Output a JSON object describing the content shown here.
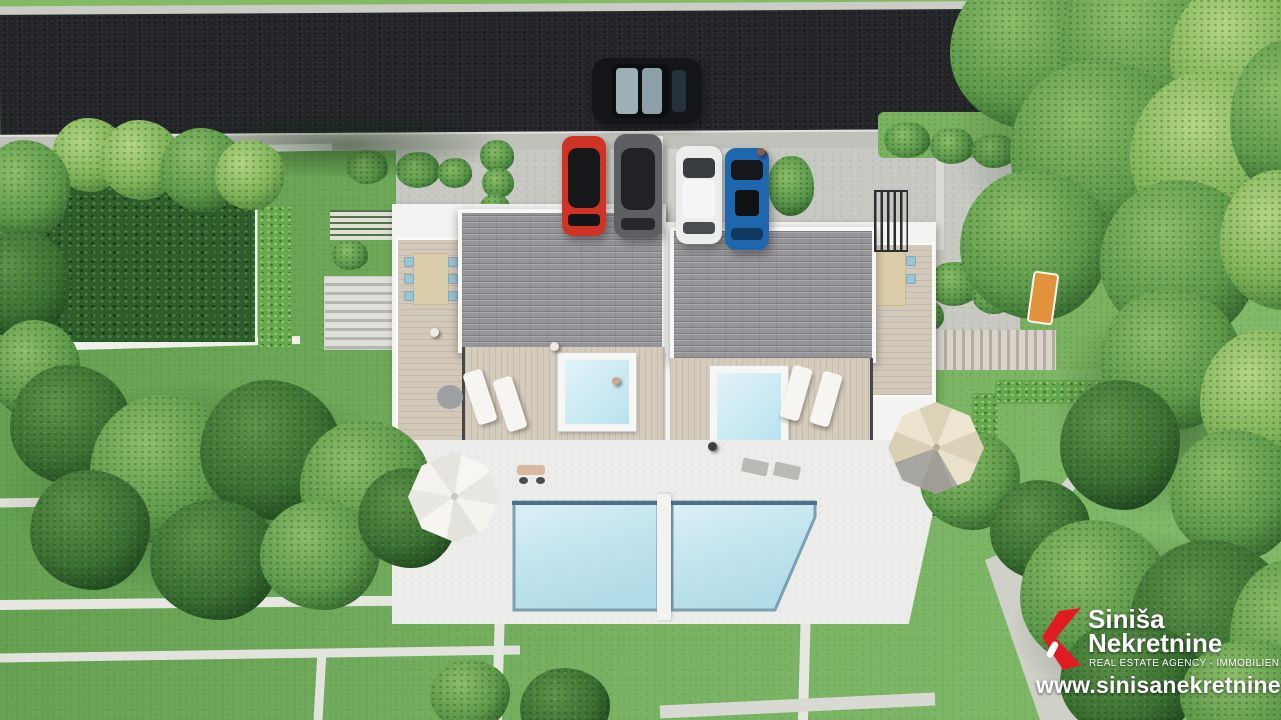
{
  "watermark": {
    "brand_line1": "Siniša",
    "brand_line2": "Nekretnine",
    "tagline": "REAL ESTATE AGENCY - IMMOBILIEN",
    "website": "www.sinisanekretnine.hr",
    "accent_color": "#e01b22",
    "text_color": "#ffffff"
  },
  "scene": {
    "type": "aerial-3d-architectural-render",
    "subject": "twin villas with rooftop terraces, plunge pools, garden and street parking",
    "vehicles": [
      {
        "name": "car-on-road",
        "color": "#141518"
      },
      {
        "name": "parked-car-red",
        "color": "#cf3327"
      },
      {
        "name": "parked-car-gray",
        "color": "#5d5f62"
      },
      {
        "name": "parked-car-white",
        "color": "#eceded"
      },
      {
        "name": "parked-car-blue",
        "color": "#1e66ae"
      }
    ],
    "palette": {
      "asphalt": "#232528",
      "sidewalk": "#c9cac5",
      "concrete": "#c7c8c2",
      "grass": "#6fa85a",
      "roof_tiles": "#96969a",
      "deck_wood": "#d5ccbe",
      "pool_water": "#c3e5ee",
      "hedge_dark": "#2d5d2a"
    }
  }
}
